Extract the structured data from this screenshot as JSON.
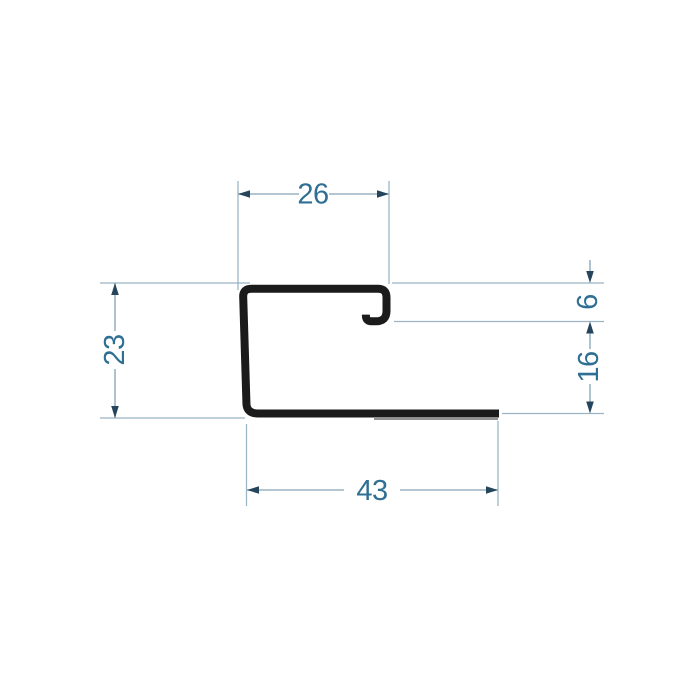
{
  "drawing": {
    "title": "profile-cross-section-drawing",
    "background_color": "#ffffff",
    "profile_color": "#1b1b1b",
    "profile_shadow_color": "#6e6e6e",
    "line_color": "#9bb4c3",
    "arrow_color": "#24455c",
    "text_color": "#2f6f94",
    "dimensions": {
      "top_width": "26",
      "left_height": "23",
      "lip_depth": "6",
      "right_height": "16",
      "bottom_width": "43"
    }
  }
}
